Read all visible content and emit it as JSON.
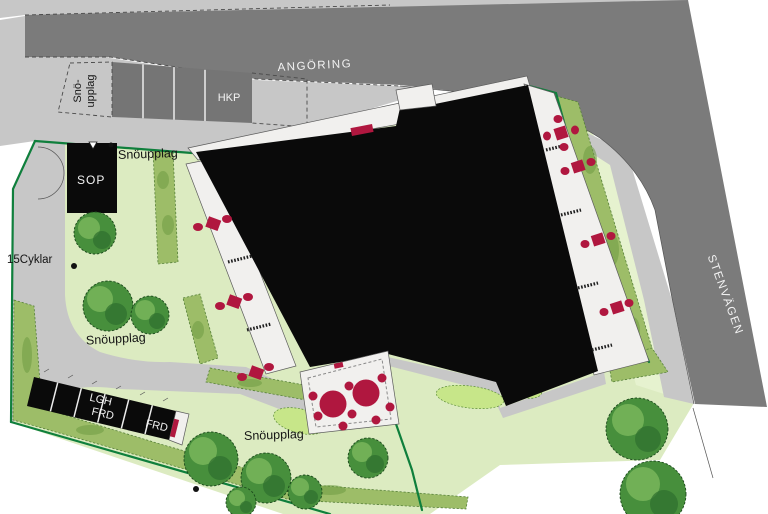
{
  "labels": {
    "road_top": "ANGÖRING",
    "road_right": "STENVÄGEN",
    "handicap_parking": "HKP",
    "snow_storage_line1": "Snö-",
    "snow_storage_line2": "upplag",
    "snow_storage": "Snöupplag",
    "waste_room": "SOP",
    "bike_parking": "15Cyklar",
    "apartment_storage_line1": "LGH",
    "apartment_storage_line2": "FRD",
    "storage": "FRD"
  },
  "colors": {
    "road_gray": "#7b7b7b",
    "paving_gray": "#c7c7c7",
    "lawn_green": "#dcebc1",
    "lawn_light": "#e6f2cf",
    "bush_green": "#c7e689",
    "hedge_green": "#9dbd68",
    "hedge_dark": "#6e9a41",
    "tree_green": "#478f3c",
    "tree_light": "#79b65a",
    "tree_dark": "#2e6d2e",
    "building_black": "#0a0a0a",
    "furniture_red": "#b0173f",
    "boundary_green": "#0f7f3c"
  },
  "icons": {
    "tree": "deciduous-tree",
    "hedge": "hedge-strip",
    "table_group": "outdoor-table-and-chairs",
    "bench": "bench",
    "boundary": "property-boundary-line"
  }
}
